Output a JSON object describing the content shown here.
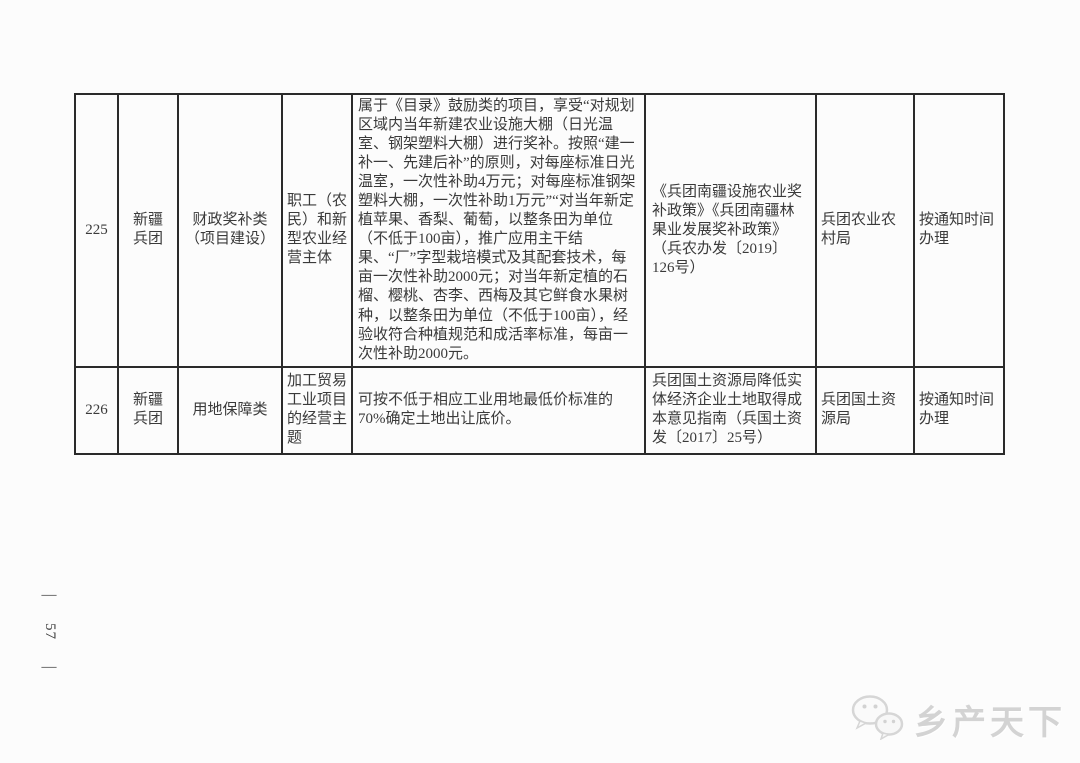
{
  "page": {
    "number": "57",
    "dash": "—"
  },
  "table": {
    "rows": [
      {
        "id": "225",
        "region": "新疆兵团",
        "category": "财政奖补类（项目建设）",
        "subject": "职工（农民）和新型农业经营主体",
        "detail": "属于《目录》鼓励类的项目，享受“对规划区域内当年新建农业设施大棚（日光温室、钢架塑料大棚）进行奖补。按照“建一补一、先建后补”的原则，对每座标准日光温室，一次性补助4万元；对每座标准钢架塑料大棚，一次性补助1万元”“对当年新定植苹果、香梨、葡萄，以整条田为单位（不低于100亩），推广应用主干结果、“厂”字型栽培模式及其配套技术，每亩一次性补助2000元；对当年新定植的石榴、樱桃、杏李、西梅及其它鲜食水果树种，以整条田为单位（不低于100亩），经验收符合种植规范和成活率标准，每亩一次性补助2000元。",
        "policy": "《兵团南疆设施农业奖补政策》《兵团南疆林果业发展奖补政策》（兵农办发〔2019〕126号）",
        "department": "兵团农业农村局",
        "timing": "按通知时间办理"
      },
      {
        "id": "226",
        "region": "新疆兵团",
        "category": "用地保障类",
        "subject": "加工贸易工业项目的经营主题",
        "detail": "可按不低于相应工业用地最低价标准的70%确定土地出让底价。",
        "policy": "兵团国土资源局降低实体经济企业土地取得成本意见指南（兵国土资发〔2017〕25号）",
        "department": "兵团国土资源局",
        "timing": "按通知时间办理"
      }
    ]
  },
  "watermark": {
    "icon": "wechat-chat-bubbles-icon",
    "text": "乡产天下",
    "color": "#d3d3d3"
  }
}
